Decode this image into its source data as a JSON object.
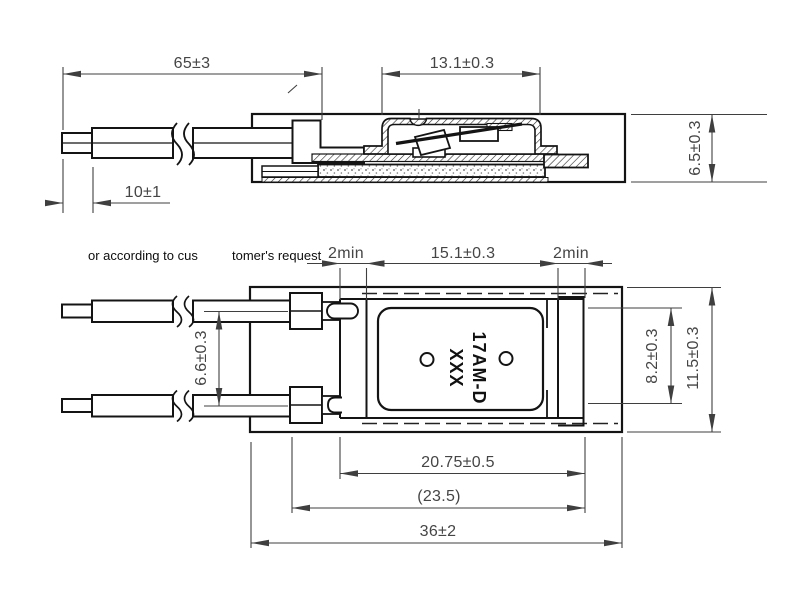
{
  "drawing": {
    "type": "engineering-drawing-thermal-protector",
    "note": {
      "left": "or according to cus",
      "right": "tomer's request"
    },
    "part_marking": {
      "line1": "17AM-D",
      "line2": "XXX"
    },
    "side_view": {
      "lead_length": "65±3",
      "strip_length": "10±1",
      "cap_width": "13.1±0.3",
      "height": "6.5±0.3"
    },
    "plan_view": {
      "clearance_left": "2min",
      "cap_length": "15.1±0.3",
      "clearance_right": "2min",
      "lead_spacing": "6.6±0.3",
      "body_width": "8.2±0.3",
      "overall_width": "11.5±0.3",
      "base_length": "20.75±0.5",
      "ref_length": "(23.5)",
      "overall_length": "36±2"
    },
    "colors": {
      "object_line": "#141414",
      "dimension_line": "#3f3f3f",
      "background": "#ffffff"
    }
  }
}
